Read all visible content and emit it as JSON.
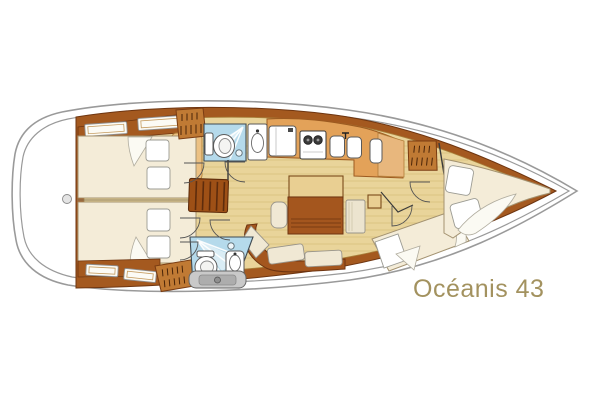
{
  "title": {
    "text": "Océanis 43"
  },
  "diagram": {
    "type": "floorplan",
    "subject": "sailboat-interior-layout",
    "orientation": "bow-right-stern-left",
    "colors": {
      "title_text": "#a3925f",
      "hull_outline": "#9a9a9a",
      "deck_wood": "#a4591f",
      "deck_wood_dark": "#6e3510",
      "floor": "#e9d49a",
      "floor_plank": "#c9a85c",
      "bed": "#f4ecd8",
      "bed_outline": "#a39270",
      "cushion": "#f0e8d4",
      "wood_furniture": "#a4561e",
      "counter_orange": "#e3a259",
      "counter_light": "#e8b77d",
      "locker_wood": "#c07a34",
      "table_top": "#e9cf92",
      "bath_floor": "#b5daeb"
    },
    "rooms": [
      "aft-port-cabin",
      "aft-starboard-cabin",
      "companionway",
      "forward-head",
      "galley",
      "salon",
      "nav-station",
      "aft-head",
      "forward-dressing-area",
      "forward-cabin"
    ],
    "fixtures": [
      "double-berth",
      "pillow",
      "drawer-cabinet",
      "hanging-locker",
      "companionway-steps",
      "toilet",
      "shower-drain",
      "washbasin",
      "icebox",
      "two-burner-stove",
      "double-sink",
      "saloon-table",
      "u-settee",
      "nav-seat",
      "v-berth",
      "transom-fixture",
      "stern-fitting"
    ]
  }
}
